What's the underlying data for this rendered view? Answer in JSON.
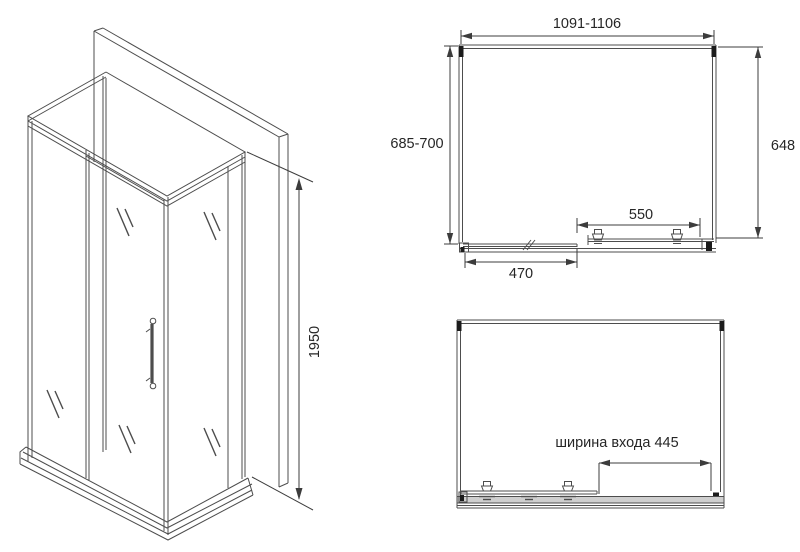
{
  "drawing": {
    "type": "shower-enclosure-technical-drawing",
    "colors": {
      "background": "#ffffff",
      "line": "#4d4d4d",
      "dimension_line": "#3c3c3c",
      "profile_fill": "#1b1b1b",
      "rail_fill": "#cfcfcf",
      "text": "#262626"
    },
    "isometric_view": {
      "height_label": "1950"
    },
    "top_view": {
      "width_label": "1091-1106",
      "left_depth_label": "685-700",
      "right_depth_label": "648",
      "door_width_label": "550",
      "fixed_panel_label": "470"
    },
    "entrance_plan_view": {
      "entrance_width_label": "ширина входа 445"
    }
  }
}
